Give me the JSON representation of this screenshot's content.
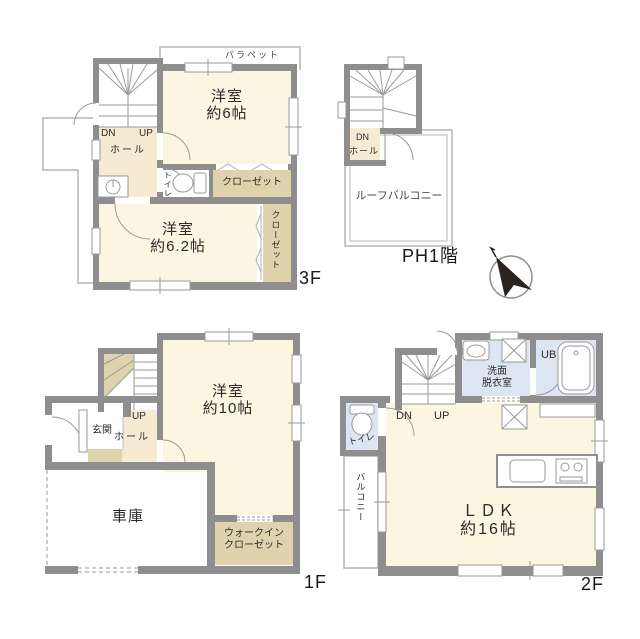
{
  "palette": {
    "wall": "#8E8E8E",
    "thin_line": "#B5B5B5",
    "cream_room": "#FBF6E2",
    "peach_hall": "#F7EAD2",
    "tan_closet": "#DFD3AE",
    "blue_sanitary": "#DCE5F1",
    "compass_dark": "#2A2320"
  },
  "floor_3f": {
    "floor_label": "3F",
    "parapet": "パラペット",
    "stairs_down": "DN",
    "stairs_up": "UP",
    "hall": "ホール",
    "toilet": "トイレ",
    "bedroom_6": {
      "line1": "洋室",
      "line2": "約6帖"
    },
    "closet_top": "クローゼット",
    "bedroom_62": {
      "line1": "洋室",
      "line2": "約6.2帖"
    },
    "closet_side": "クローゼット"
  },
  "floor_ph1": {
    "floor_label": "PH1階",
    "stairs_down": "DN",
    "hall": "ホール",
    "roof_balcony": "ルーフバルコニー"
  },
  "floor_1f": {
    "floor_label": "1F",
    "stairs_up": "UP",
    "hall": "ホール",
    "entrance": "玄関",
    "bedroom_10": {
      "line1": "洋室",
      "line2": "約10帖"
    },
    "garage": "車庫",
    "walk_in_closet": {
      "line1": "ウォークイン",
      "line2": "クローゼット"
    }
  },
  "floor_2f": {
    "floor_label": "2F",
    "stairs_down": "DN",
    "stairs_up": "UP",
    "washroom": {
      "line1": "洗面",
      "line2": "脱衣室"
    },
    "unit_bath": "UB",
    "toilet": "トイレ",
    "balcony": "バルコニー",
    "ldk": {
      "line1": "ＬＤＫ",
      "line2": "約16帖"
    }
  }
}
